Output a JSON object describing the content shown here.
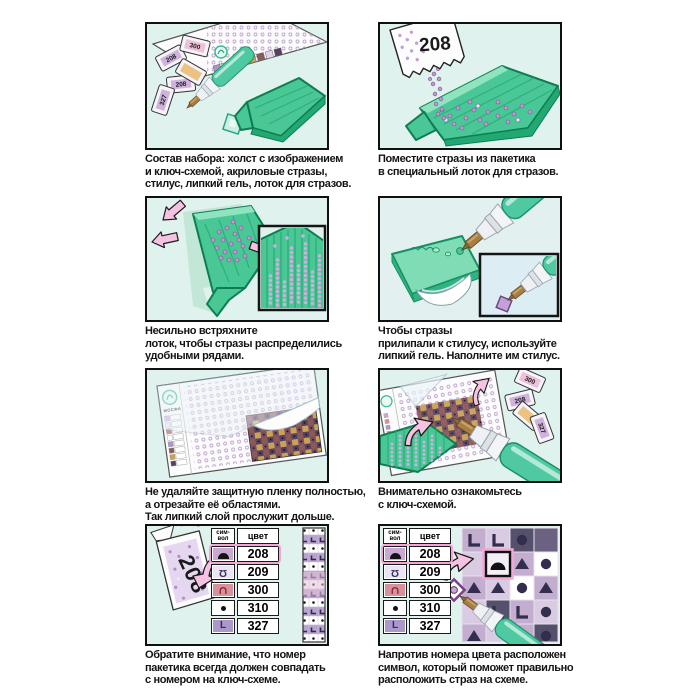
{
  "page": {
    "background": "#ffffff"
  },
  "panels": [
    {
      "name": "kit-contents",
      "caption": [
        "Состав набора: холст с изображением",
        "и ключ-схемой, акриловые стразы,",
        "стилус, липкий гель, лоток для стразов."
      ],
      "packet_labels": [
        "208",
        "300",
        "208",
        "327"
      ]
    },
    {
      "name": "pour-into-tray",
      "caption": [
        "Поместите стразы из пакетика",
        "в специальный лоток для стразов."
      ],
      "packet_number": "208"
    },
    {
      "name": "shake-tray",
      "caption": [
        "Несильно встряхните",
        "лоток, чтобы стразы распределились",
        "удобными рядами."
      ]
    },
    {
      "name": "sticky-gel",
      "caption": [
        "Чтобы стразы",
        "прилипали к стилусу, используйте",
        "липкий гель. Наполните им стилус."
      ]
    },
    {
      "name": "protective-film",
      "caption": [
        "Не удаляйте защитную пленку полностью,",
        "а отрезайте её областями.",
        "Так липкий слой прослужит дольше."
      ],
      "brand": "МОСФА"
    },
    {
      "name": "study-key-chart",
      "caption": [
        "Внимательно ознакомьтесь",
        "с ключ-схемой."
      ],
      "packet_labels": [
        "300",
        "208",
        "327"
      ]
    },
    {
      "name": "match-packet-number",
      "caption": [
        "Обратите внимание, что номер",
        "пакетика всегда должен совпадать",
        "с номером на ключ-схеме."
      ],
      "packet_number": "208"
    },
    {
      "name": "symbol-placement",
      "caption": [
        "Напротив номера цвета расположен",
        "символ, который поможет правильно",
        "расположить страз на схеме."
      ]
    }
  ],
  "key_table": {
    "headers": {
      "symbol_top": "сим-",
      "symbol_bottom": "вол",
      "color": "цвет"
    },
    "rows": [
      {
        "symbol": "dome",
        "color": "208",
        "highlighted": true
      },
      {
        "symbol": "inverted-omega",
        "color": "209",
        "highlighted": false
      },
      {
        "symbol": "arch",
        "color": "300",
        "highlighted": false
      },
      {
        "symbol": "dot",
        "color": "310",
        "highlighted": false
      },
      {
        "symbol": "letter-l",
        "color": "327",
        "highlighted": false
      }
    ],
    "highlighted_color": "208"
  },
  "colors": {
    "panel_bg": "#e0f2ee",
    "tray_green": "#49c795",
    "tray_edge": "#0e7d52",
    "arrow_pink": "#f6c2e1",
    "bead_purple": "#c09ad1",
    "table_highlight": "#f2a8d6",
    "stylus_teal": "#4fc9a2"
  }
}
